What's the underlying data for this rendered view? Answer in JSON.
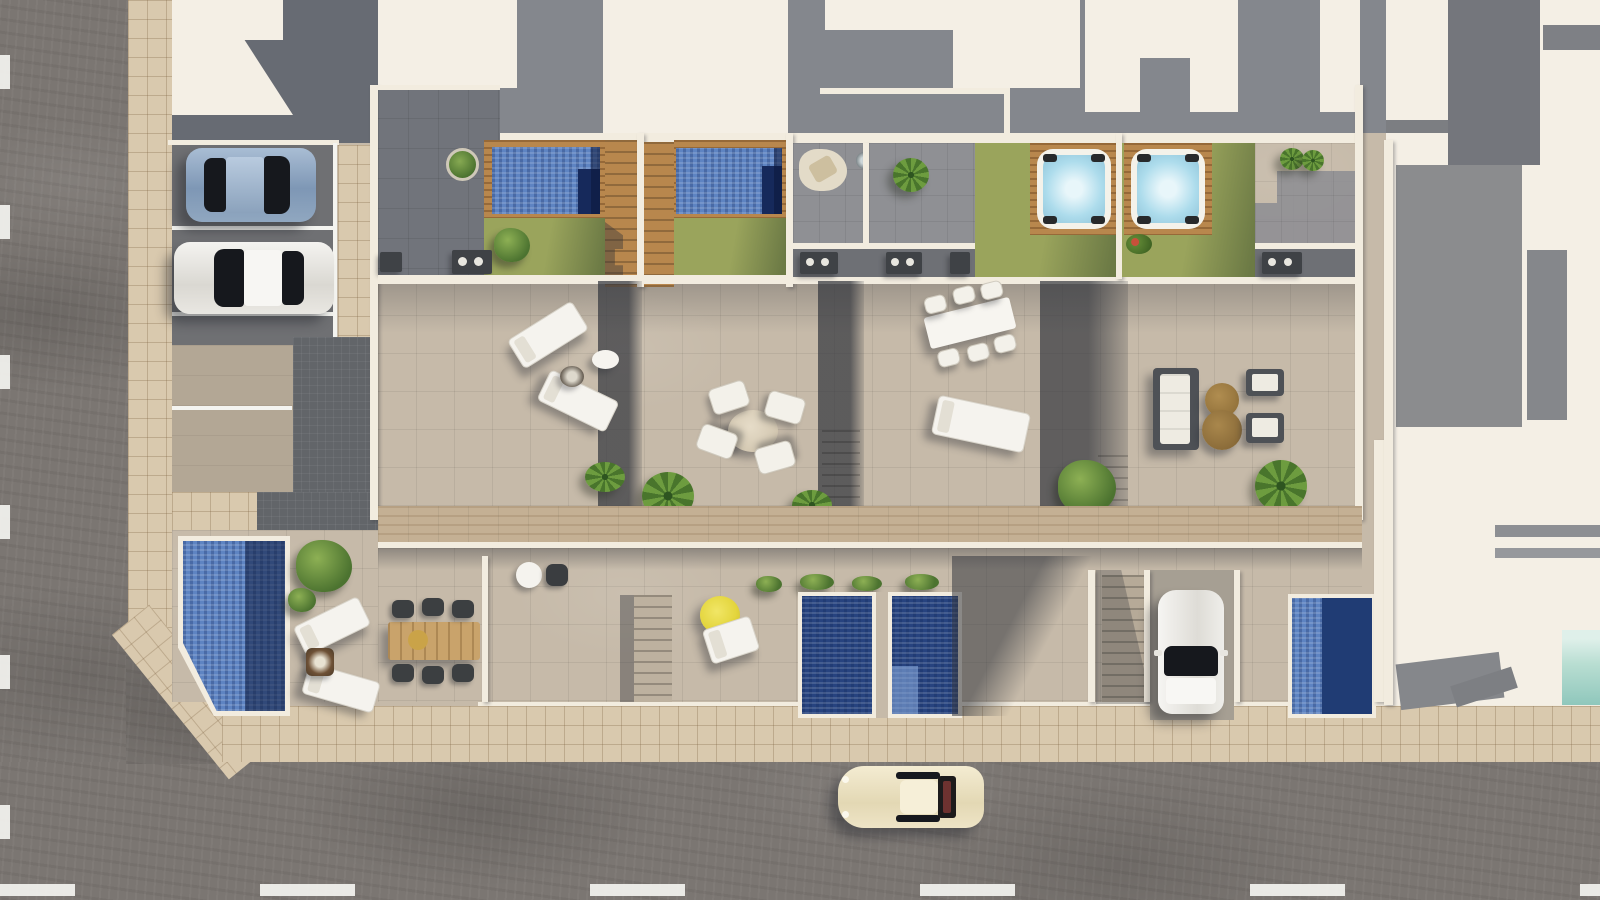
{
  "scene": {
    "type": "aerial-3d-architectural-render",
    "description": "Top-down 3D rendering of a row of four modern townhouses with rooftop terraces, rooftop pools, hot tubs, lawns, ground-floor patios with plunge pools, street parking with cars, surrounding roads, sidewalks and neighbouring white buildings.",
    "townhouse_count": 4,
    "rooftop_pools": 2,
    "hot_tubs": 2,
    "ground_plunge_pools": 3,
    "corner_house_pool": 1,
    "vehicles": [
      {
        "name": "blue-sedan",
        "location": "street-parking-top",
        "color": "#8fa8c4"
      },
      {
        "name": "white-sedan",
        "location": "street-parking-top",
        "color": "#edecec"
      },
      {
        "name": "white-hatchback",
        "location": "private-driveway",
        "color": "#f1efe9"
      },
      {
        "name": "cream-classic-coupe",
        "location": "bottom-road",
        "color": "#ece2c2"
      }
    ],
    "amenities": [
      "rooftop pools",
      "wood decks",
      "artificial lawns",
      "hot tubs",
      "bbq counters",
      "sun loungers",
      "dining sets",
      "sofa set",
      "yellow parasol",
      "fire pits",
      "palms"
    ]
  },
  "palette": {
    "road": "#7b7672",
    "sidewalk": "#d9c9ae",
    "terrace": "#c6baa9",
    "wall": "#f2ecdf",
    "roofWhite": "#f4efe5",
    "stripGray": "#84878d",
    "blockDark": "#676b73",
    "patioGray": "#8f9094",
    "recessGray": "#6e7075",
    "paver": "#626569",
    "parkAsphalt": "#6f7073",
    "parkLight": "#b3a795",
    "lawn": "#9aa45c",
    "lawnShade": "#6c7a45",
    "wood": "#b8874d",
    "woodLight": "#c4b094",
    "poolDeep": "#1f3b76",
    "poolLight": "#5e84c2",
    "poolInset": "#16295b",
    "tubWater": "#addcec",
    "teal": "#b9ded2",
    "umbrella": "#e3d53c",
    "rug": "#e3dbc8",
    "sofa": "#4e5156",
    "cushion": "#eeebe2",
    "tableBrown": "#9d7a42",
    "tableWood": "#c9a36b",
    "bbq": "#3f4246",
    "glass": "#16181d",
    "concrete": "#a69f93",
    "laneMark": "#f4f4f0"
  }
}
